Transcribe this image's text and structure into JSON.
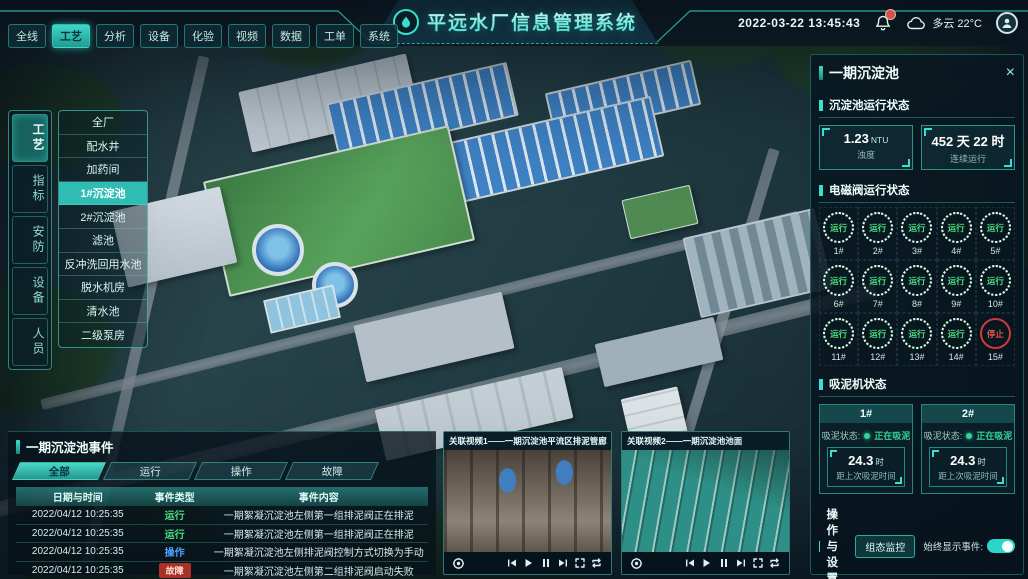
{
  "colors": {
    "accent": "#35e0d0",
    "green": "#4ade80",
    "red": "#e0483f",
    "blue": "#4aa3ff"
  },
  "header": {
    "title": "平远水厂信息管理系统",
    "datetime": "2022-03-22 13:45:43",
    "weather": "多云 22°C",
    "nav_tabs": [
      {
        "label": "全线",
        "active": false
      },
      {
        "label": "工艺",
        "active": true
      },
      {
        "label": "分析",
        "active": false
      },
      {
        "label": "设备",
        "active": false
      },
      {
        "label": "化验",
        "active": false
      },
      {
        "label": "视频",
        "active": false
      },
      {
        "label": "数据",
        "active": false
      },
      {
        "label": "工单",
        "active": false
      },
      {
        "label": "系统",
        "active": false
      }
    ]
  },
  "left_rail": {
    "tabs": [
      {
        "label": "工艺",
        "active": true
      },
      {
        "label": "指标",
        "active": false
      },
      {
        "label": "安防",
        "active": false
      },
      {
        "label": "设备",
        "active": false
      },
      {
        "label": "人员",
        "active": false
      }
    ]
  },
  "left_menu": {
    "items": [
      {
        "label": "全厂",
        "active": false
      },
      {
        "label": "配水井",
        "active": false
      },
      {
        "label": "加药间",
        "active": false
      },
      {
        "label": "1#沉淀池",
        "active": true
      },
      {
        "label": "2#沉淀池",
        "active": false
      },
      {
        "label": "滤池",
        "active": false
      },
      {
        "label": "反冲洗回用水池",
        "active": false
      },
      {
        "label": "脱水机房",
        "active": false
      },
      {
        "label": "清水池",
        "active": false
      },
      {
        "label": "二级泵房",
        "active": false
      }
    ]
  },
  "right_panel": {
    "title": "一期沉淀池",
    "close_icon": "×",
    "running": {
      "title": "沉淀池运行状态",
      "stats": [
        {
          "value": "1.23",
          "unit": "NTU",
          "label": "浊度"
        },
        {
          "value": "452 天 22 时",
          "unit": "",
          "label": "连续运行"
        }
      ]
    },
    "valves": {
      "title": "电磁阀运行状态",
      "items": [
        {
          "id": "1#",
          "status": "运行"
        },
        {
          "id": "2#",
          "status": "运行"
        },
        {
          "id": "3#",
          "status": "运行"
        },
        {
          "id": "4#",
          "status": "运行"
        },
        {
          "id": "5#",
          "status": "运行"
        },
        {
          "id": "6#",
          "status": "运行"
        },
        {
          "id": "7#",
          "status": "运行"
        },
        {
          "id": "8#",
          "status": "运行"
        },
        {
          "id": "9#",
          "status": "运行"
        },
        {
          "id": "10#",
          "status": "运行"
        },
        {
          "id": "11#",
          "status": "运行"
        },
        {
          "id": "12#",
          "status": "运行"
        },
        {
          "id": "13#",
          "status": "运行"
        },
        {
          "id": "14#",
          "status": "运行"
        },
        {
          "id": "15#",
          "status": "停止",
          "stopped": true
        }
      ]
    },
    "mud": {
      "title": "吸泥机状态",
      "machines": [
        {
          "id": "1#",
          "status_label": "吸泥状态:",
          "status": "正在吸泥",
          "value": "24.3",
          "unit": "时",
          "caption": "距上次吸泥时间"
        },
        {
          "id": "2#",
          "status_label": "吸泥状态:",
          "status": "正在吸泥",
          "value": "24.3",
          "unit": "时",
          "caption": "距上次吸泥时间"
        }
      ]
    },
    "ops": {
      "title": "操作与设置",
      "button_label": "组态监控",
      "toggle_label": "始终显示事件:",
      "toggle_on": true
    }
  },
  "events": {
    "title": "一期沉淀池事件",
    "tabs": [
      {
        "label": "全部",
        "active": true
      },
      {
        "label": "运行",
        "active": false
      },
      {
        "label": "操作",
        "active": false
      },
      {
        "label": "故障",
        "active": false
      }
    ],
    "columns": [
      "日期与时间",
      "事件类型",
      "事件内容"
    ],
    "rows": [
      {
        "time": "2022/04/12 10:25:35",
        "type": "运行",
        "type_color": "green",
        "content": "一期絮凝沉淀池左侧第一组排泥阀正在排泥"
      },
      {
        "time": "2022/04/12 10:25:35",
        "type": "运行",
        "type_color": "green",
        "content": "一期絮凝沉淀池左侧第一组排泥阀正在排泥"
      },
      {
        "time": "2022/04/12 10:25:35",
        "type": "操作",
        "type_color": "blue",
        "content": "一期絮凝沉淀池左侧排泥阀控制方式切换为手动"
      },
      {
        "time": "2022/04/12 10:25:35",
        "type": "故障",
        "type_color": "red",
        "content": "一期絮凝沉淀池左侧第二组排泥阀启动失败"
      }
    ]
  },
  "videos": {
    "items": [
      {
        "title": "关联视频1——一期沉淀池平流区排泥管廊",
        "thumb": "pipes"
      },
      {
        "title": "关联视频2——一期沉淀池池面",
        "thumb": "pool"
      }
    ]
  }
}
